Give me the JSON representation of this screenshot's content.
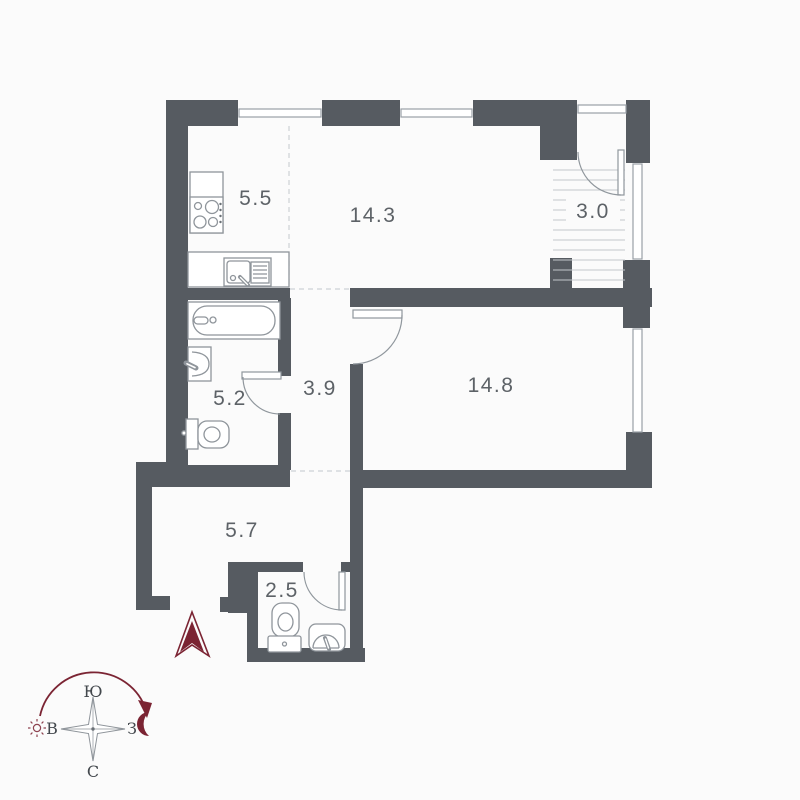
{
  "plan": {
    "type": "apartment-floor-plan",
    "rooms": [
      {
        "name": "kitchen",
        "area": "5.5"
      },
      {
        "name": "living-room",
        "area": "14.3"
      },
      {
        "name": "balcony",
        "area": "3.0"
      },
      {
        "name": "bathroom",
        "area": "5.2"
      },
      {
        "name": "hall",
        "area": "3.9"
      },
      {
        "name": "bedroom",
        "area": "14.8"
      },
      {
        "name": "corridor",
        "area": "5.7"
      },
      {
        "name": "wc",
        "area": "2.5"
      }
    ],
    "compass": {
      "top": "Ю",
      "bottom": "С",
      "left": "В",
      "right": "З"
    },
    "colors": {
      "wall": "#565b61",
      "accent": "#7b2433",
      "fixture_line": "#90979d",
      "label": "#5d6267"
    }
  }
}
